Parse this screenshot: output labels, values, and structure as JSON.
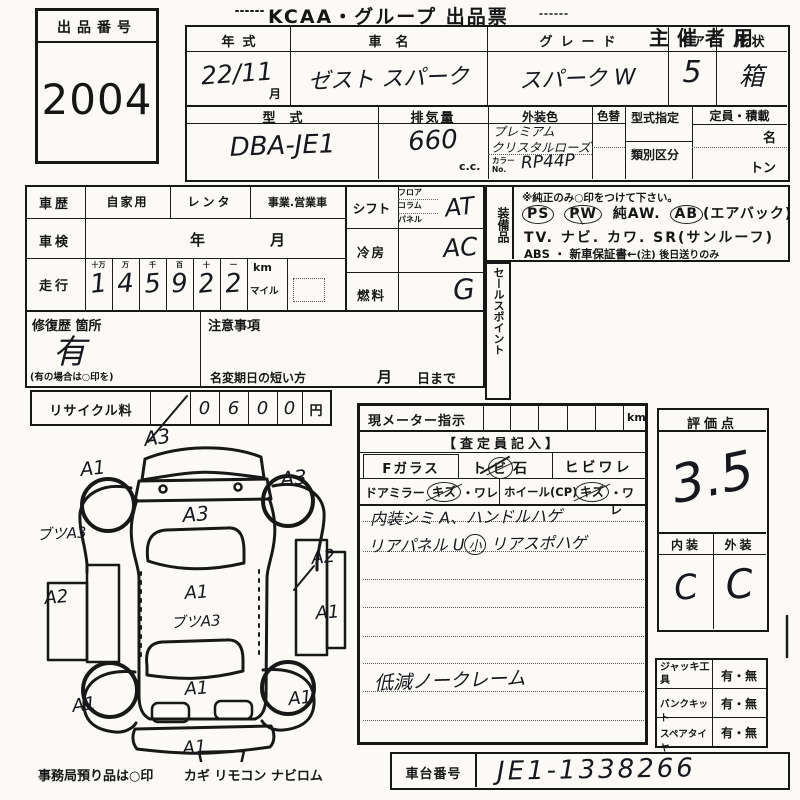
{
  "page": {
    "title": "KCAA・グループ 出品票",
    "audience": "主催者用",
    "exhibit": {
      "label": "出品番号",
      "number": "2004"
    }
  },
  "vehicle": {
    "year": {
      "label": "年式",
      "value": "22/11",
      "unit": "月"
    },
    "name": {
      "label": "車名",
      "value": "ゼスト スパーク"
    },
    "grade": {
      "label": "グレード",
      "value": "スパーク W"
    },
    "doors": {
      "label": "ドア",
      "value": "5"
    },
    "shape": {
      "label": "形状",
      "value": "箱"
    },
    "model": {
      "label": "型式",
      "value": "DBA-JE1"
    },
    "displacement": {
      "label": "排気量",
      "value": "660",
      "unit": "c.c."
    },
    "color": {
      "label": "外装色",
      "line1": "プレミアム",
      "line2": "クリスタルローズ",
      "no_label1": "カラー",
      "no_label2": "No.",
      "no_value": "RP44P"
    },
    "color_change": {
      "label": "色替"
    },
    "type_designation": {
      "label": "型式指定"
    },
    "classification": {
      "label": "類別区分"
    },
    "capacity": {
      "label": "定員・積載",
      "persons_unit": "名",
      "load_unit": "トン"
    }
  },
  "status": {
    "history": {
      "label": "車歴",
      "options": [
        "自家用",
        "レンタ",
        "事業.営業車"
      ]
    },
    "inspection": {
      "label": "車検",
      "year_unit": "年",
      "month_unit": "月"
    },
    "mileage": {
      "label": "走行",
      "place_headers": [
        "十万",
        "万",
        "千",
        "百",
        "十",
        "一"
      ],
      "digits": [
        "1",
        "4",
        "5",
        "9",
        "2",
        "2"
      ],
      "unit_km": "km",
      "unit_mile": "マイル"
    },
    "shift": {
      "label": "シフト",
      "positions": [
        "フロア",
        "コラム",
        "パネル"
      ],
      "value": "AT"
    },
    "cooling": {
      "label": "冷房",
      "value": "AC"
    },
    "fuel": {
      "label": "燃料",
      "value": "G"
    },
    "repair": {
      "label": "修復歴 箇所",
      "value": "有",
      "note": "(有の場合は○印を)"
    },
    "caution": {
      "label": "注意事項"
    },
    "name_change": {
      "label": "名変期日の短い方",
      "month": "月",
      "day": "日まで"
    },
    "recycle": {
      "label": "リサイクル料",
      "digits": [
        "0",
        "6",
        "0",
        "0"
      ],
      "unit": "円"
    }
  },
  "equipment": {
    "label": "装備品",
    "note": "※純正のみ○印をつけて下さい。",
    "ps": "PS",
    "pw": "PW",
    "aw": "純AW.",
    "ab": "AB",
    "ab_suffix": "(エアバック)",
    "line2": "TV. ナビ. カワ. SR(サンルーフ)",
    "line3_prefix": "ABS ・ 新車保証書←",
    "line3_note": "(注) 後日送りのみ"
  },
  "sales_point_label": "セールスポイント",
  "assessment": {
    "meter_label": "現メーター指示",
    "meter_unit": "km",
    "header": "【査定員記入】",
    "f_glass": "Fガラス",
    "stone_pre": "ト",
    "stone_circled": "ビ",
    "stone_post": "石",
    "crack": "ヒビワレ",
    "mirror_label": "ドアミラー",
    "mirror_kizu": "キズ",
    "mirror_ware": "・ワレ",
    "wheel_label": "ホイール(CP)",
    "wheel_kizu": "キズ",
    "wheel_ware": "・ワレ",
    "note1": "内装シミ A、ハンドルハゲ",
    "note2_pre": "リアパネル U",
    "note2_circled": "小",
    "note2_post": " リアスポハゲ",
    "note3": "低減ノークレーム"
  },
  "score": {
    "label": "評価点",
    "value": "3.5",
    "interior_label": "内装",
    "exterior_label": "外装",
    "interior": "C",
    "exterior": "C"
  },
  "accessories": {
    "jack": {
      "label": "ジャッキ工具",
      "value": "有・無"
    },
    "puncture_kit": {
      "label": "パンクキット",
      "value": "有・無"
    },
    "spare_tire": {
      "label": "スペアタイヤ",
      "value": "有・無"
    }
  },
  "chassis": {
    "label": "車台番号",
    "value": "JE1-1338266"
  },
  "footer": {
    "office_note": "事務局預り品は○印",
    "items": "カギ リモコン ナビロム"
  },
  "diagram": {
    "labels": [
      {
        "text": "A3",
        "x": 110,
        "y": 34,
        "size": 20,
        "rot": -8
      },
      {
        "text": "A1",
        "x": 46,
        "y": 64,
        "size": 19,
        "rot": -6
      },
      {
        "text": "A3",
        "x": 246,
        "y": 74,
        "size": 20,
        "rot": -5
      },
      {
        "text": "A3",
        "x": 148,
        "y": 110,
        "size": 20,
        "rot": -4
      },
      {
        "text": "ブツA3",
        "x": 2,
        "y": 128,
        "size": 15,
        "rot": -3
      },
      {
        "text": "A2",
        "x": 10,
        "y": 192,
        "size": 18,
        "rot": -5
      },
      {
        "text": "A2",
        "x": 277,
        "y": 152,
        "size": 18,
        "rot": -6
      },
      {
        "text": "A1",
        "x": 281,
        "y": 207,
        "size": 18,
        "rot": -4
      },
      {
        "text": "A1",
        "x": 150,
        "y": 187,
        "size": 18,
        "rot": -4
      },
      {
        "text": "ブツA3",
        "x": 136,
        "y": 216,
        "size": 15,
        "rot": -3
      },
      {
        "text": "A1",
        "x": 150,
        "y": 283,
        "size": 18,
        "rot": -4
      },
      {
        "text": "A1",
        "x": 38,
        "y": 300,
        "size": 18,
        "rot": -8
      },
      {
        "text": "A1",
        "x": 254,
        "y": 293,
        "size": 18,
        "rot": -6
      },
      {
        "text": "A1",
        "x": 148,
        "y": 342,
        "size": 18,
        "rot": -4
      }
    ]
  }
}
